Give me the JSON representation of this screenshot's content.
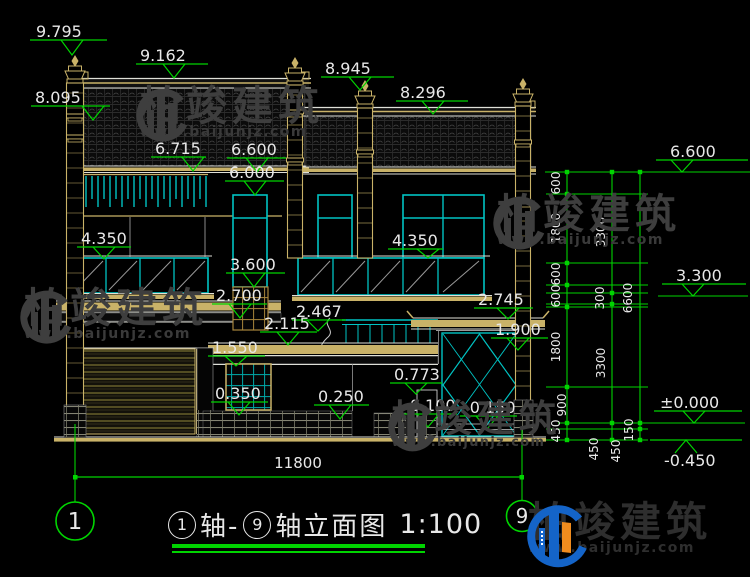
{
  "drawing_title": {
    "axis_from": "1",
    "axis_mid": "轴-",
    "axis_to": "9",
    "rest": "轴立面图",
    "scale": "1:100"
  },
  "axis_bubbles": {
    "left": "1",
    "right": "9"
  },
  "overall_width_dim": "11800",
  "elevations": [
    "9.795",
    "9.162",
    "8.945",
    "8.296",
    "8.095",
    "6.715",
    "6.600",
    "6.000",
    "4.350",
    "4.350",
    "3.600",
    "2.700",
    "2.467",
    "2.115",
    "1.550",
    "2.745",
    "1.900",
    "0.773",
    "0.350",
    "0.250",
    "-0.100",
    "-0.150",
    "±0.000",
    "-0.450",
    "6.600",
    "3.300"
  ],
  "dim_chains": {
    "inner": [
      "600",
      "1800",
      "600",
      "600",
      "1800",
      "900",
      "450"
    ],
    "middle": [
      "3300",
      "300",
      "3300",
      "450"
    ],
    "outer": [
      "6600",
      "150",
      "450"
    ]
  },
  "watermark": {
    "brand": "柏竣建筑",
    "url": "www.baijunjz.com"
  },
  "colors": {
    "background": "#000000",
    "dimension_green": "#00d400",
    "window_cyan": "#00c3c3",
    "wood_tan": "#c9b268",
    "line_white": "#dfe0d8",
    "watermark_gray": "#3e3e3e",
    "logo_blue": "#1464c8",
    "logo_orange": "#f08c1e"
  }
}
